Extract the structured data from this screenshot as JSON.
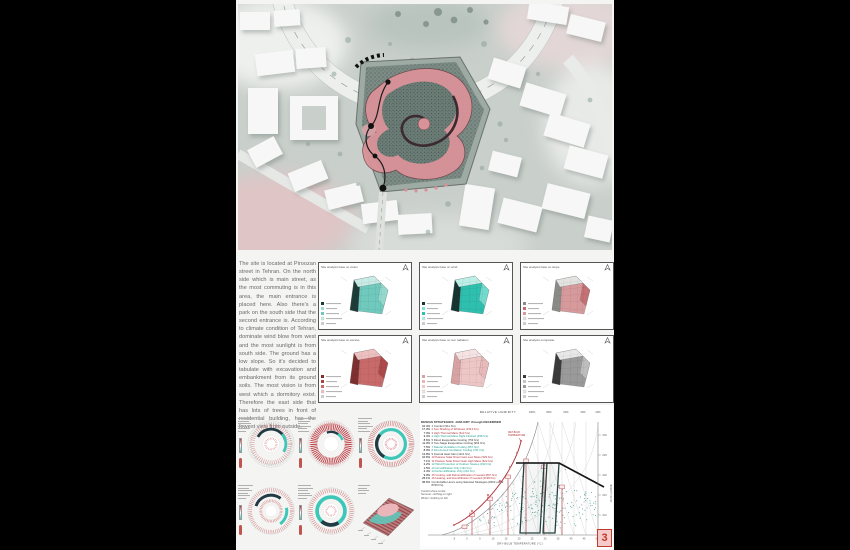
{
  "board": {
    "page_number": "3"
  },
  "description": {
    "paragraph": "The site is located at Piroozan street in Tehran. On the north side which is main street, as the most commuting is in this area, the main entrance is placed here. Also there's a park on the south side that the second entrance is. According to climate condition of Tehran, dominate wind blow from west and the most sunlight is from south side. The ground has a low slope. So it's decided to tabulate with excavation and embankment from its ground soils. The most vision is from west which a dormitory exist. Therefore the east side that has lots of trees in front of residential building, has the fewest view from outside."
  },
  "analysis_panels": [
    {
      "title": "Site analysis base on vision",
      "colors": {
        "light": "#c8ebe5",
        "mid": "#6fc9bd",
        "dark": "#1f3b38",
        "accent": "#9adcd2"
      }
    },
    {
      "title": "Site analysis base on wind",
      "colors": {
        "light": "#bdeee8",
        "mid": "#2fbfae",
        "dark": "#173433",
        "accent": "#7fe0d4"
      }
    },
    {
      "title": "Site analysis base on slope",
      "colors": {
        "light": "#e3e3e1",
        "mid": "#d79a9c",
        "dark": "#8a8a88",
        "accent": "#c26b6e"
      }
    },
    {
      "title": "Site analysis base on access",
      "colors": {
        "light": "#eec1c1",
        "mid": "#c96a6a",
        "dark": "#7e2f2f",
        "accent": "#a94444"
      }
    },
    {
      "title": "Site analysis base on sun radiation",
      "colors": {
        "light": "#f6e3e3",
        "mid": "#eec6c6",
        "dark": "#d9a2a2",
        "accent": "#e8b8b8"
      }
    },
    {
      "title": "Site analysis composite",
      "colors": {
        "light": "#e8e8e8",
        "mid": "#9a9a9a",
        "dark": "#3a3a3a",
        "accent": "#c4c4c4"
      }
    }
  ],
  "psych_chart": {
    "header": "DESIGN STRATEGIES: JANUARY through DECEMBER",
    "strategies": [
      {
        "pct": "10.4%",
        "label": "1 Comfort (911 hrs)",
        "c": "k"
      },
      {
        "pct": "17.3%",
        "label": "2 Sun Shading of Windows (1513 hrs)",
        "c": "r"
      },
      {
        "pct": "7.0%",
        "label": "3 High Thermal Mass (612 hrs)",
        "c": "r"
      },
      {
        "pct": "3.4%",
        "label": "4 High Thermal Mass Night Flushed (298 hrs)",
        "c": "t"
      },
      {
        "pct": "8.6%",
        "label": "5 Direct Evaporative Cooling (753 hrs)",
        "c": "k"
      },
      {
        "pct": "11.0%",
        "label": "6 Two-Stage Evaporative Cooling (964 hrs)",
        "c": "k"
      },
      {
        "pct": "7.5%",
        "label": "7 Natural Ventilation Cooling (657 hrs)",
        "c": "t"
      },
      {
        "pct": "8.0%",
        "label": "8 Fan-Forced Ventilation Cooling (701 hrs)",
        "c": "t"
      },
      {
        "pct": "12.8%",
        "label": "9 Internal Heat Gain (1121 hrs)",
        "c": "k"
      },
      {
        "pct": "10.6%",
        "label": "10 Passive Solar Direct Gain Low Mass (929 hrs)",
        "c": "r"
      },
      {
        "pct": "7.1%",
        "label": "11 Passive Solar Direct Gain High Mass (622 hrs)",
        "c": "r"
      },
      {
        "pct": "2.2%",
        "label": "12 Wind Protection of Outdoor Spaces (193 hrs)",
        "c": "t"
      },
      {
        "pct": "1.5%",
        "label": "13 Humidification Only (131 hrs)",
        "c": "t"
      },
      {
        "pct": "2.4%",
        "label": "14 Dehumidification Only (210 hrs)",
        "c": "t"
      },
      {
        "pct": "9.9%",
        "label": "15 Cooling, add Dehumidification if needed (867 hrs)",
        "c": "r"
      },
      {
        "pct": "25.1%",
        "label": "16 Heating, add Humidification if needed (2199 hrs)",
        "c": "r"
      },
      {
        "pct": "96.6%",
        "label": "Comfortable Hours using Selected Strategies (8462 out of 8760 hrs)",
        "c": "k"
      }
    ],
    "footnotes": [
      "Comfort Zone Limits:",
      "Summer: clothing on right",
      "Winter: clothing on left"
    ],
    "top_axis": {
      "label": "RELATIVE HUMIDITY",
      "ticks": [
        "100%",
        "80%",
        "60%",
        "40%",
        "20%"
      ]
    },
    "x_axis": {
      "label": "DRY-BULB TEMPERATURE (°C)",
      "ticks": [
        "-5",
        "0",
        "5",
        "10",
        "15",
        "20",
        "25",
        "30",
        "35",
        "40",
        "45",
        "50"
      ]
    },
    "y_axis": {
      "label": "HUMIDITY RATIO",
      "ticks": [
        ".030",
        ".025",
        ".020",
        ".015",
        ".010",
        ".005"
      ]
    },
    "annotation": {
      "line1": "WET-BULB",
      "line2": "TEMPERATURE"
    }
  },
  "colors": {
    "accent_red": "#b03039",
    "teal": "#3ec6b8",
    "dark_zone": "#24423e",
    "site_pink": "#d99298",
    "page_box_red": "#c0392b"
  }
}
